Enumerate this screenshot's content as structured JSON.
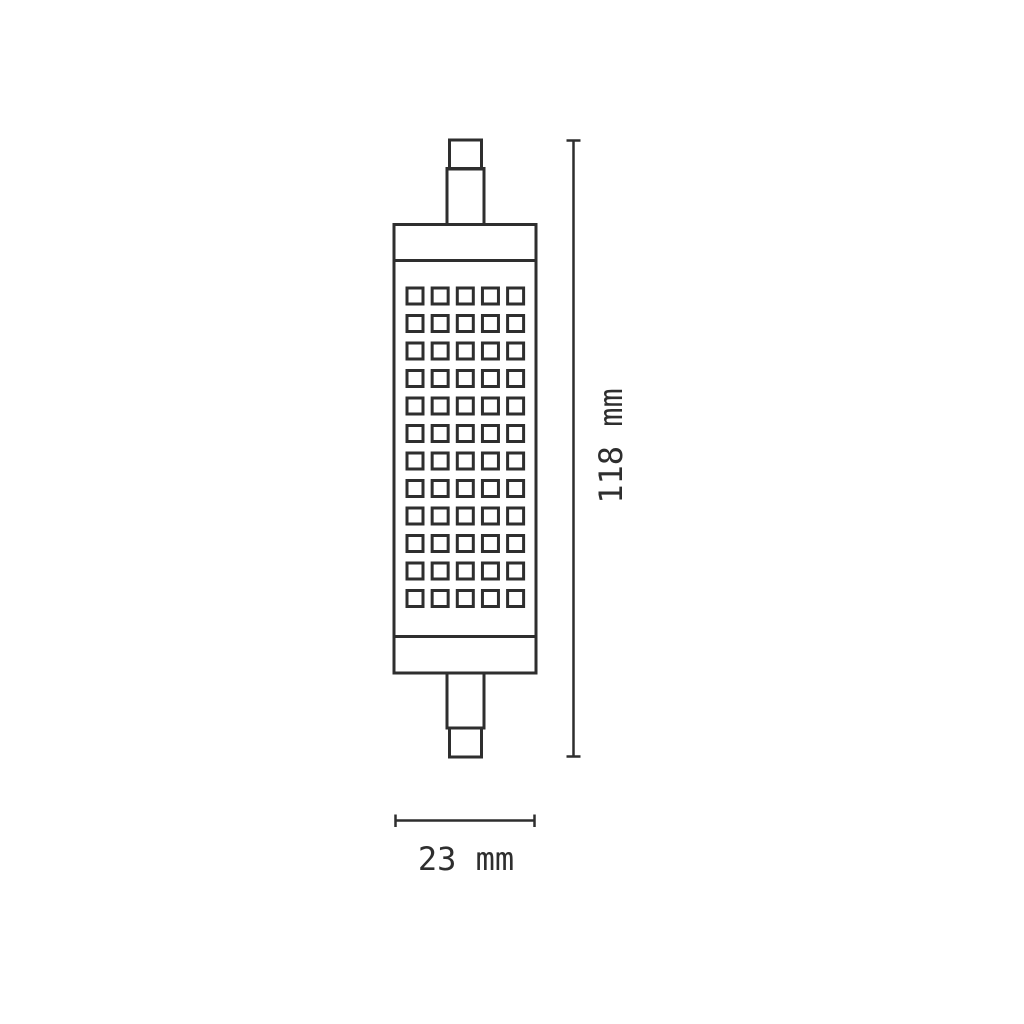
{
  "diagram": {
    "subject": "r7s-linear-led-lamp-dimension-drawing",
    "height_label": "118 mm",
    "width_label": "23 mm",
    "led_grid": {
      "rows": 12,
      "columns": 5
    },
    "line_color": "#2e2e2e",
    "background_color": "#ffffff"
  }
}
